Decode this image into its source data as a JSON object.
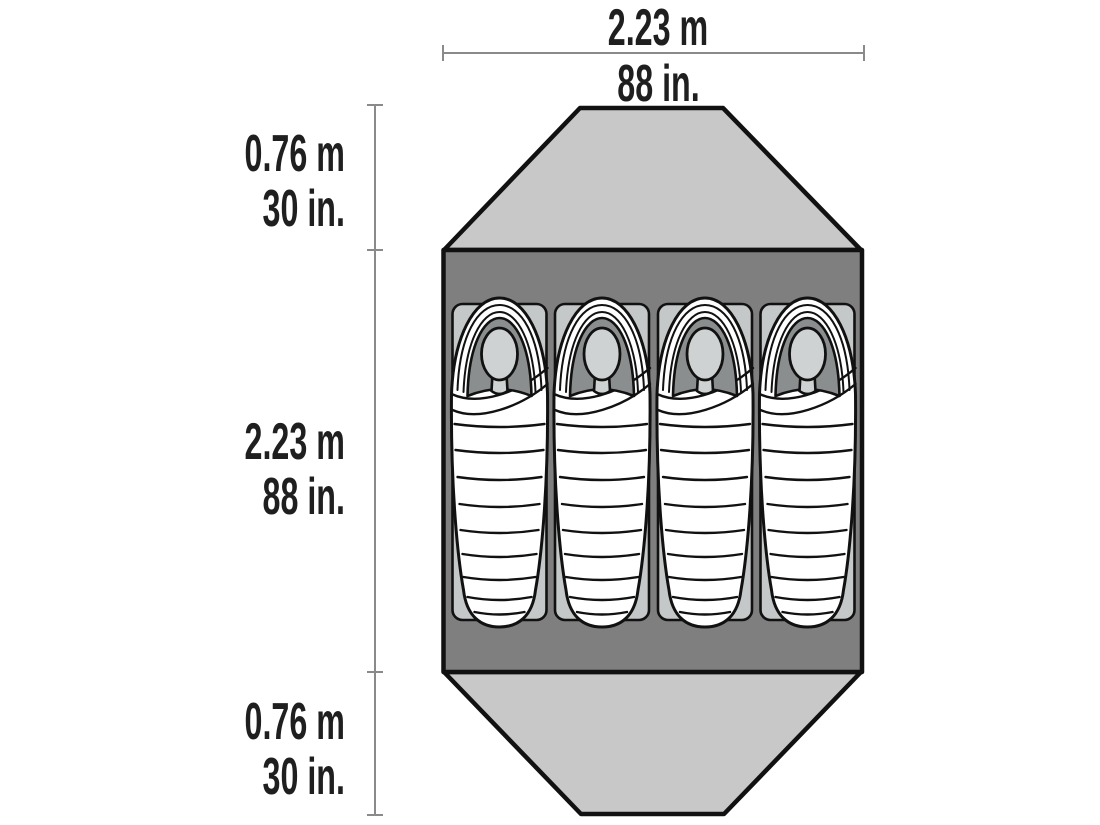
{
  "diagram": {
    "type": "tent-floorplan",
    "sleepers": 4,
    "top_dimension": {
      "metric": "2.23 m",
      "imperial": "88 in."
    },
    "left_dimensions": {
      "top_vestibule": {
        "metric": "0.76 m",
        "imperial": "30 in."
      },
      "body": {
        "metric": "2.23 m",
        "imperial": "88 in."
      },
      "bottom_vestibule": {
        "metric": "0.76 m",
        "imperial": "30 in."
      }
    },
    "colors": {
      "vestibule": "#c8c8c8",
      "body": "#7f7f7f",
      "pad": "#c5c8c8",
      "bag": "#ffffff",
      "hood": "#8b8e8e",
      "face": "#cfd2d2",
      "outline": "#111111",
      "dimension_line": "#8a8a8a",
      "text": "#1f1f1f"
    }
  }
}
